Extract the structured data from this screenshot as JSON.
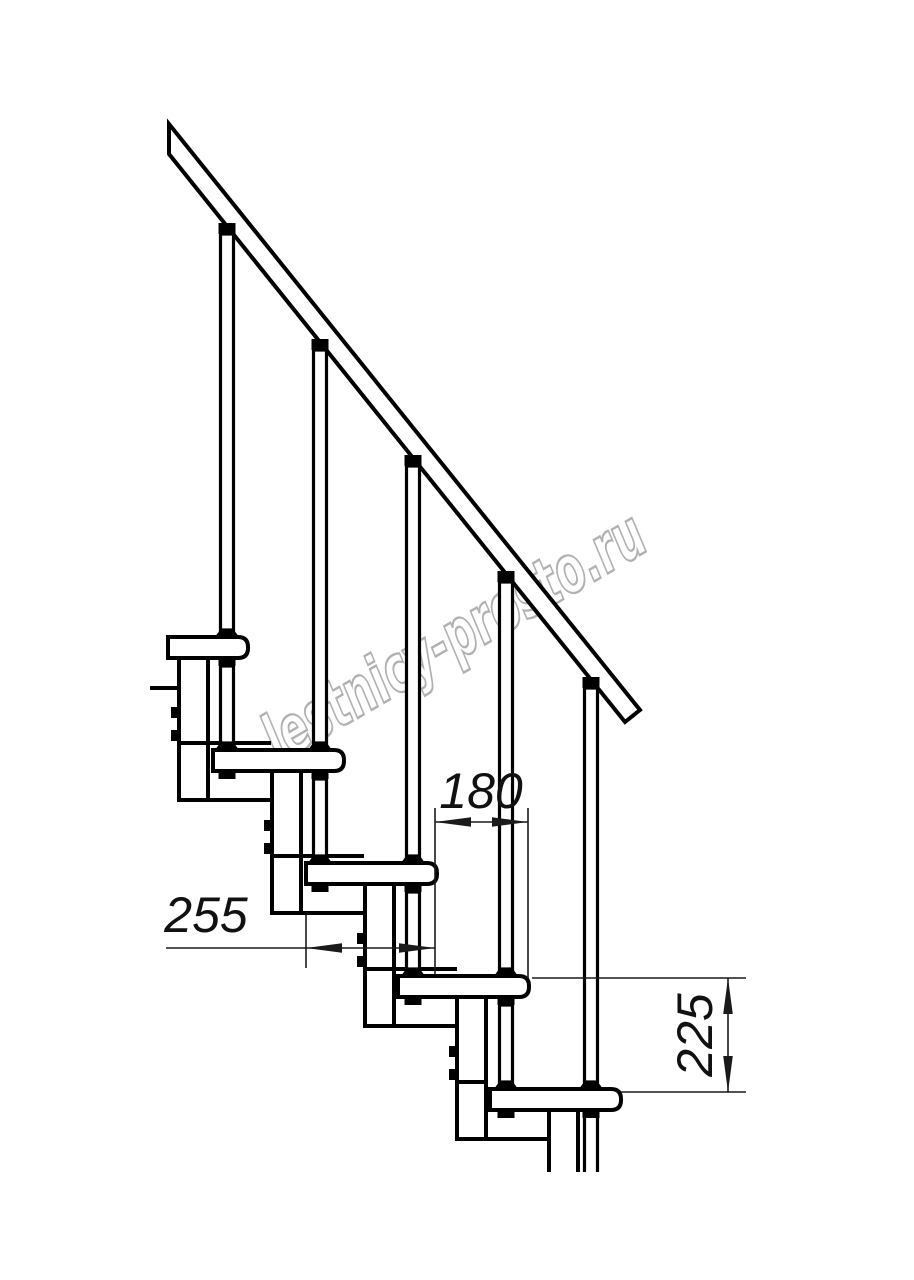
{
  "drawing": {
    "type": "technical-diagram",
    "subject": "modular staircase side view",
    "watermark": "lestnicy-prosto.ru",
    "dimensions": {
      "step_run": "180",
      "tread_depth": "255",
      "step_rise": "225"
    },
    "colors": {
      "background": "#ffffff",
      "line": "#000000",
      "dimension_line": "#1a1a1a",
      "watermark": "#9e9e9e"
    },
    "counts": {
      "treads_visible": 5,
      "balusters_visible": 5
    }
  }
}
